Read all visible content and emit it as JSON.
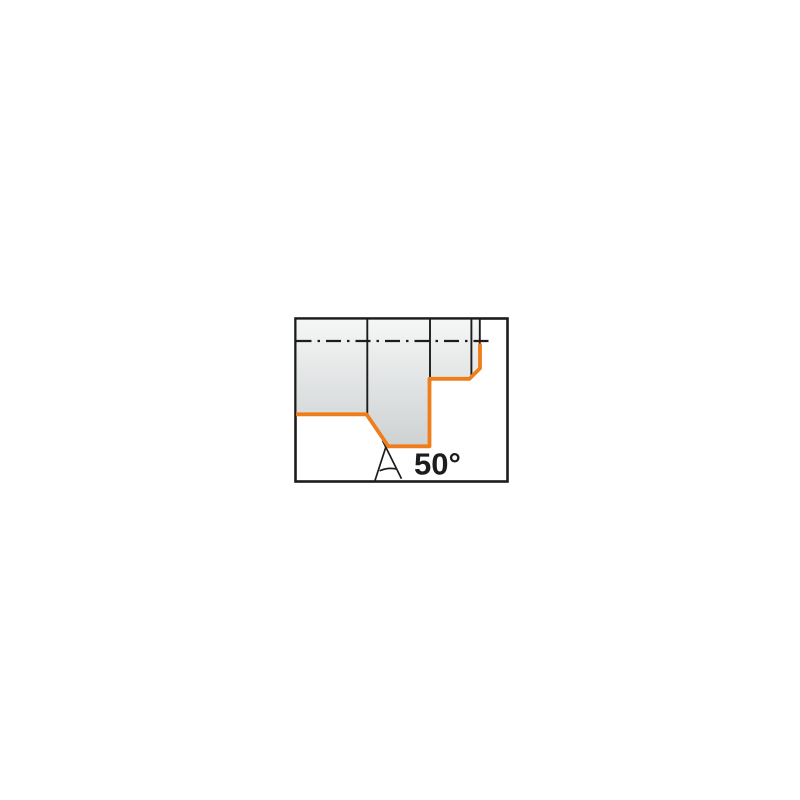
{
  "page": {
    "background": "#ffffff"
  },
  "diagram": {
    "angle_label": "50°",
    "colors": {
      "profile_accent": "#ee7d1a",
      "line": "#1c1c1c",
      "frame": "#1c1c1c",
      "label_text": "#1c1c1c",
      "workpiece_top": "#f5f6f6",
      "workpiece_bottom": "#cdd1d2",
      "frame_fill": "#ffffff"
    }
  }
}
